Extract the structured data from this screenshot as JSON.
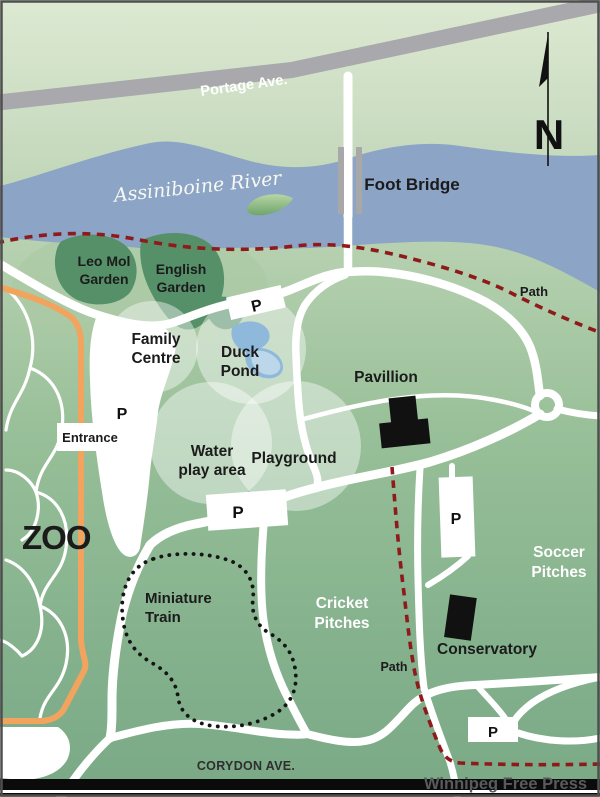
{
  "map_title": "Assiniboine Park area map",
  "colors": {
    "park_green_top": "#dde9d2",
    "park_green_bottom": "#7aa986",
    "river_blue": "#8ca4c5",
    "road_gray": "#a8a8ad",
    "bridge_gray": "#a8a8a8",
    "garden_green": "#569069",
    "garden_halo_green": "#a9c9a2",
    "zoo_boundary_orange": "#f2a45f",
    "trail_red": "#8e1a1c",
    "pond_blue": "#8fb9da",
    "pond_blue_light": "#bcd6ea",
    "building_black": "#111111",
    "road_white": "#ffffff"
  },
  "labels": {
    "portage_ave": "Portage Ave.",
    "assiniboine_river": "Assiniboine River",
    "foot_bridge": "Foot Bridge",
    "compass_n": "N",
    "leo_mol_garden": [
      "Leo Mol",
      "Garden"
    ],
    "english_garden": [
      "English",
      "Garden"
    ],
    "path_upper": "Path",
    "family_centre": [
      "Family",
      "Centre"
    ],
    "duck_pond": [
      "Duck",
      "Pond"
    ],
    "entrance": "Entrance",
    "zoo": "ZOO",
    "water_play_area": [
      "Water",
      "play area"
    ],
    "playground": "Playground",
    "pavillion": "Pavillion",
    "miniature_train": [
      "Miniature",
      "Train"
    ],
    "cricket_pitches": [
      "Cricket",
      "Pitches"
    ],
    "soccer_pitches": [
      "Soccer",
      "Pitches"
    ],
    "conservatory": "Conservatory",
    "path_lower": "Path",
    "corydon_ave": "CORYDON AVE.",
    "credit": "Winnipeg Free Press",
    "parking": "P"
  }
}
